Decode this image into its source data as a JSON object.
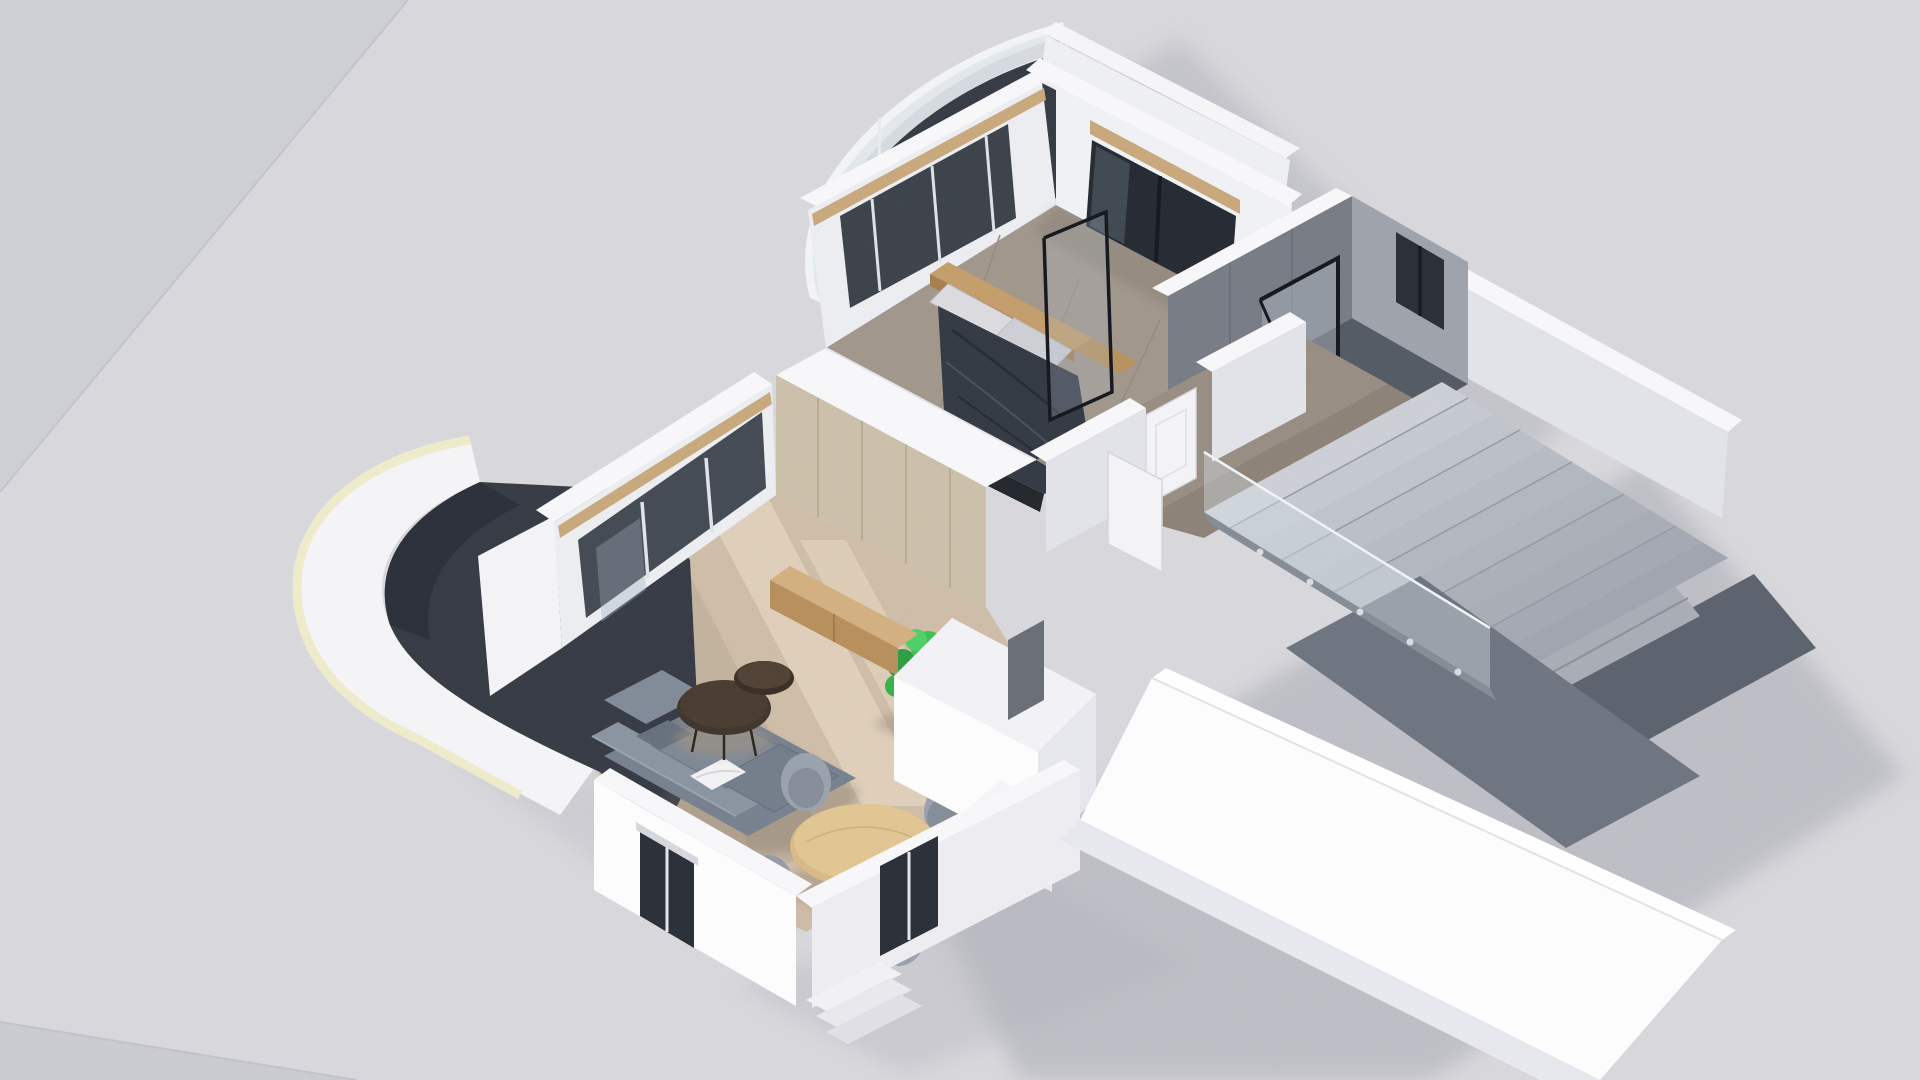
{
  "scene": {
    "type": "3d-floorplan-render",
    "view": "isometric-cutaway-top",
    "rooms": [
      "bedroom",
      "bathroom",
      "hallway",
      "living-room",
      "dining-area",
      "stairwell",
      "entry"
    ],
    "exterior": [
      "top-balcony-curved-glass-railing",
      "west-balcony-curved-parapet",
      "ground-plane",
      "cast-shadows",
      "entry-steps"
    ],
    "furniture": [
      "double-bed",
      "wood-headboard",
      "pillows",
      "dark-duvet",
      "wardrobe-partition",
      "tv-screen",
      "tv-console",
      "sectional-sofa",
      "white-pillow",
      "nesting-coffee-tables",
      "round-dining-table",
      "dining-chairs",
      "monstera-plant",
      "bathtub",
      "shower-glass-screen",
      "interior-doors",
      "kitchen-entry-volume",
      "stair-treads",
      "glass-balustrade"
    ]
  },
  "palette": {
    "ground": "#d9d9dd",
    "groundDark": "#cfcfd6",
    "groundDarker": "#cbcbd2",
    "castShadow": "#b4b4bd",
    "wallWhite": "#f8f8fb",
    "wallBright": "#fdfdfe",
    "wallFaceShaded": "#e3e4ea",
    "bedroomFloor": "#a2978c",
    "hallFloor": "#998e83",
    "livingFloor": "#cfbda8",
    "livingSun": "#f0e2cb",
    "balconyFloor": "#363b45",
    "copingCream": "#eeeccb",
    "bathFloor": "#555b65",
    "bathWallDark": "#787c86",
    "bathWallLight": "#9fa3ac",
    "tubConcrete": "#b7bbc0",
    "stairTread": "#ccd0d6",
    "stairTreadDark": "#a8adb6",
    "stairwellFloor": "#5d636e",
    "guardWall": "#6f7580",
    "glassTint": "#d5dde4",
    "glassDark": "#2e343d",
    "frameBlack": "#15181d",
    "beamWood": "#c9a97c",
    "panelWood": "#ccc0ab",
    "consoleWood": "#d3b080",
    "consoleWoodDark": "#b8905c",
    "headboardWood": "#c49e6b",
    "duvetDark": "#343a44",
    "pillowLight": "#dcdce0",
    "sofaGray": "#77818f",
    "sofaGrayLight": "#8b95a2",
    "chairGray": "#9aa2ad",
    "tableWood": "#d9b987",
    "coffeeDark": "#41362d",
    "plantGreen": "#2f9e44",
    "doorWhite": "#f4f4f7"
  }
}
